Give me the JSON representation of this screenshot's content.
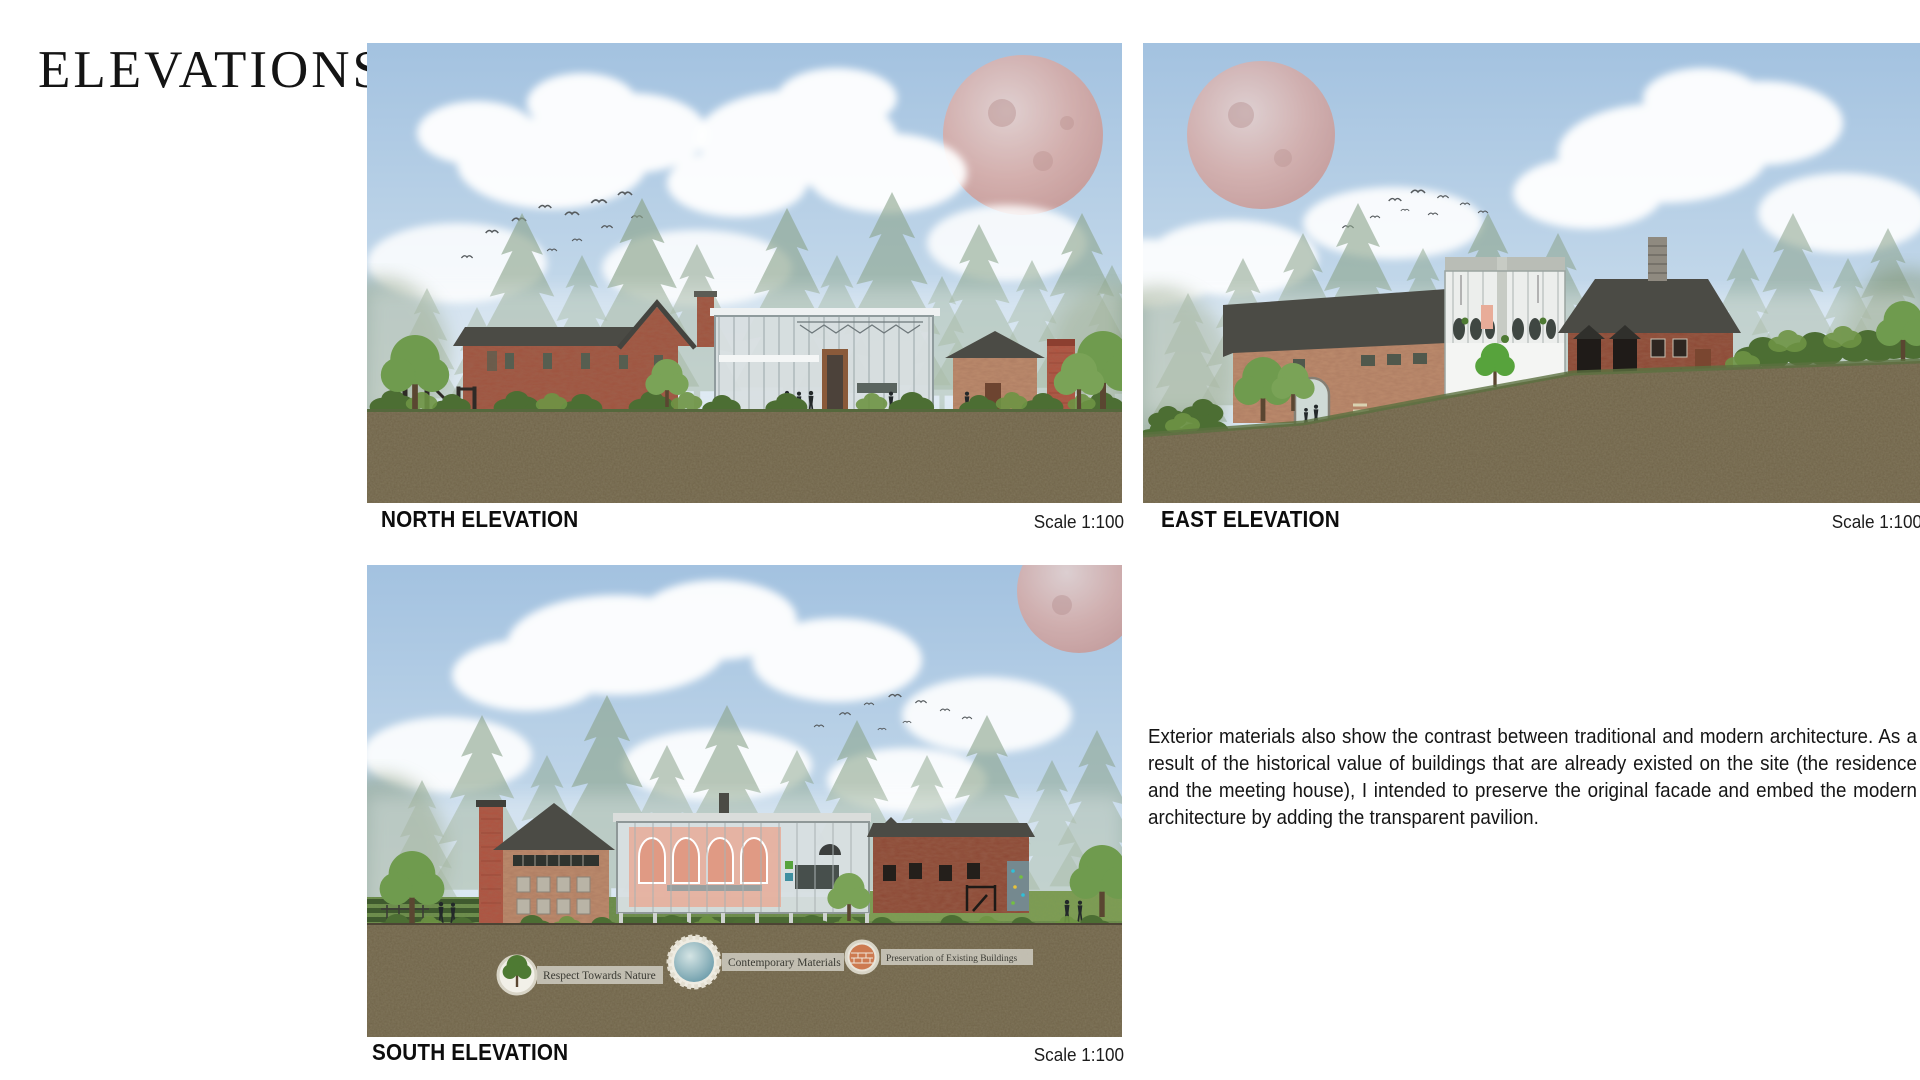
{
  "header": {
    "title": "ELEVATIONS"
  },
  "panels": {
    "north": {
      "caption": "NORTH ELEVATION",
      "scale_label": "Scale 1:100"
    },
    "east": {
      "caption": "EAST ELEVATION",
      "scale_label": "Scale 1:100"
    },
    "south": {
      "caption": "SOUTH ELEVATION",
      "scale_label": "Scale 1:100",
      "legend": {
        "nature": "Respect Towards Nature",
        "materials": "Contemporary Materials",
        "preservation": "Preservation of Existing Buildings"
      }
    }
  },
  "description": "Exterior materials also show the contrast between traditional and modern architecture. As a result of the historical value of buildings that are already existed on the site (the residence and the meeting house), I intended to preserve the original facade and embed the modern architecture by adding the transparent pavilion.",
  "colors": {
    "sky": "#aac7e2",
    "cloud": "#ffffff",
    "moon": "#d9a49b",
    "treeline": "#8aa38a",
    "soil": "#6f634a",
    "lawn": "#6a8a4a",
    "bush": "#4c6e33",
    "brick_red": "#a0543f",
    "brick_light": "#bd8d6e",
    "brick_dark": "#8d4a36",
    "roof": "#4b4b45",
    "glass": "#d8dfe1",
    "frame": "#9aa6a8",
    "tower_red": "#b05340",
    "salmon": "#e8ac98",
    "text": "#111111"
  }
}
